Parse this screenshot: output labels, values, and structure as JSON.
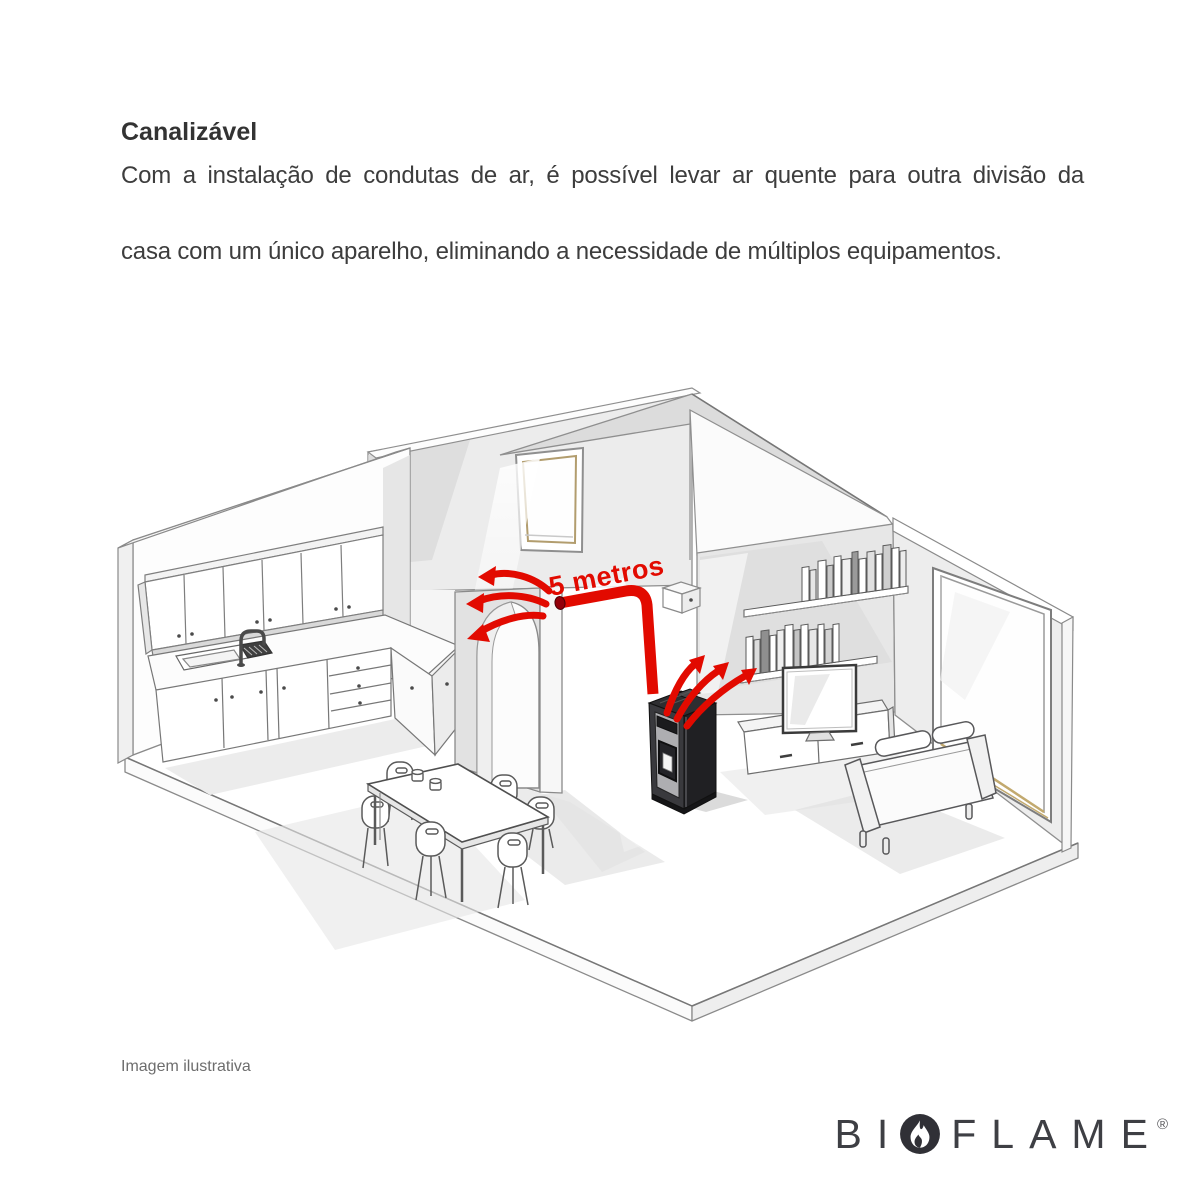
{
  "intro": {
    "title": "Canalizável",
    "body_line1": "Com a instalação de condutas de ar, é possível levar ar quente para outra divisão da",
    "body_line2": "casa com um único aparelho, eliminando a necessidade de múltiplos equipamentos."
  },
  "diagram": {
    "duct_label": "5 metros",
    "accent_color": "#e20a00",
    "duct_outlet_color": "#93000a",
    "illustration_subject": "isometric house cutaway with ducted pellet stove heating two rooms"
  },
  "footer": {
    "caption": "Imagem ilustrativa"
  },
  "logo": {
    "prefix": "BI",
    "suffix": "FLAME",
    "registered": "®",
    "icon": "flame-icon",
    "color": "#3e3f44"
  }
}
